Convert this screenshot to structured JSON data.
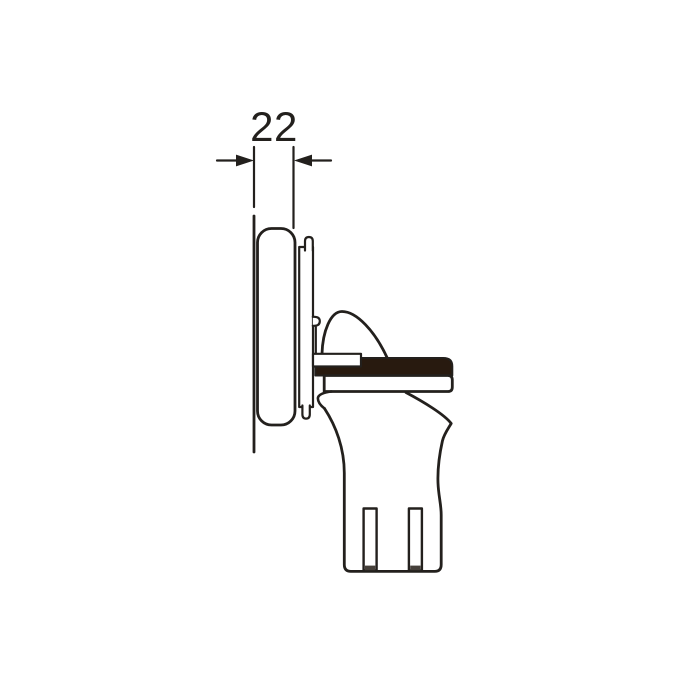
{
  "drawing": {
    "dimension_label": "22"
  },
  "colors": {
    "background": "#ffffff",
    "line": "#23201d",
    "bar_fill": "#281a0f",
    "slot_shadow": "#46403a"
  }
}
